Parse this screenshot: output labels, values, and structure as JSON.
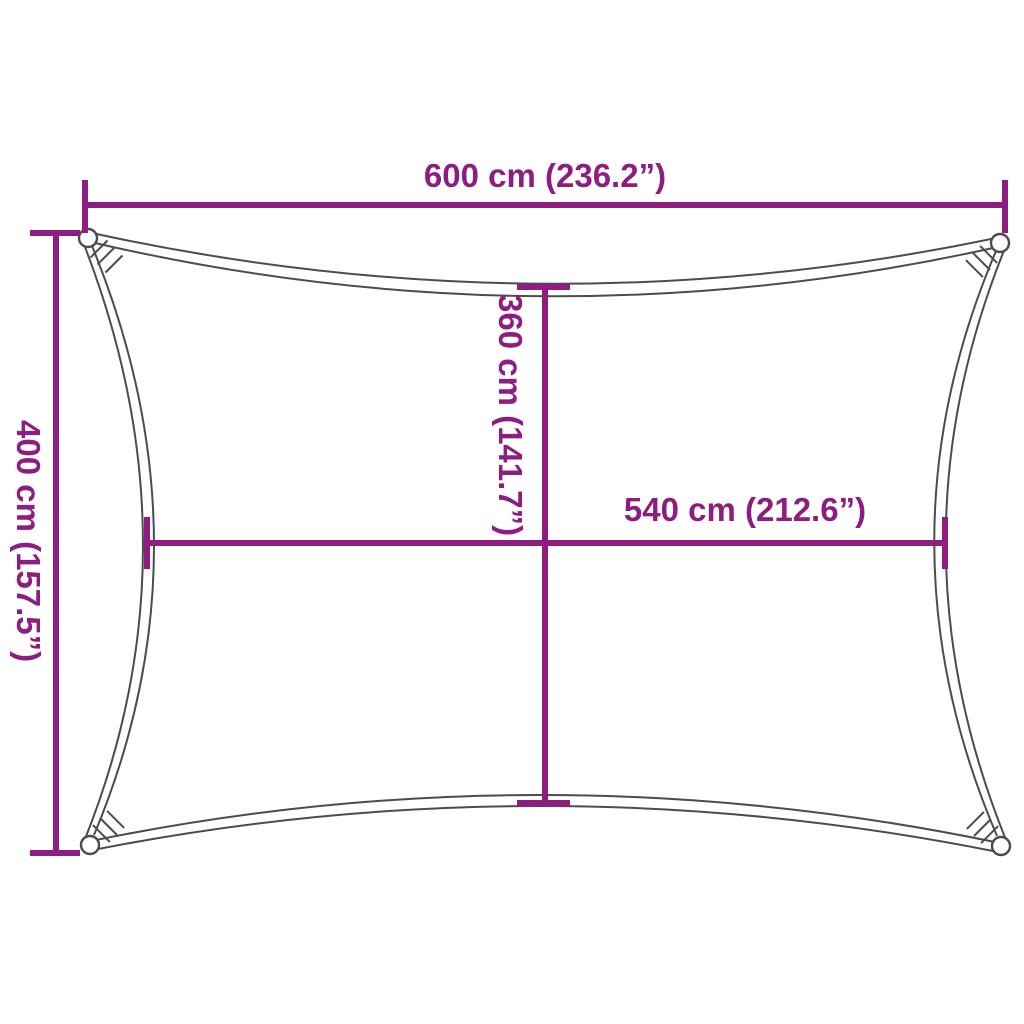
{
  "diagram": {
    "title": "shade-sail-dimension-diagram",
    "subject": "rectangular shade sail with concave edges and corner rings",
    "colors": {
      "accent": "#8e1d82",
      "outline": "#4c4c4c",
      "background": "#ffffff"
    },
    "dims": {
      "top_width": {
        "label": "600 cm (236.2”)",
        "cm": 600,
        "inch": 236.2
      },
      "left_height": {
        "label": "400 cm (157.5”)",
        "cm": 400,
        "inch": 157.5
      },
      "inner_height": {
        "label": "360 cm (141.7”)",
        "cm": 360,
        "inch": 141.7
      },
      "inner_width": {
        "label": "540 cm (212.6”)",
        "cm": 540,
        "inch": 212.6
      }
    }
  }
}
